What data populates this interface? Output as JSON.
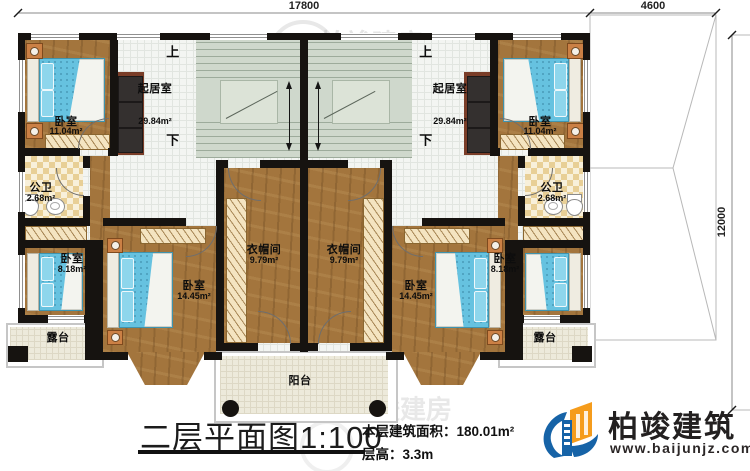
{
  "dims": {
    "width": "17800",
    "wing_width": "4600",
    "wing_height": "12000"
  },
  "nav": {
    "up": "上",
    "down": "下"
  },
  "rooms": {
    "living": {
      "name": "起居室",
      "area": "29.84m²"
    },
    "bedroom11": {
      "name": "卧室",
      "area": "11.04m²"
    },
    "bath": {
      "name": "公卫",
      "area": "2.68m²"
    },
    "closet": {
      "name": "衣帽间",
      "area": "9.79m²"
    },
    "bedroom8": {
      "name": "卧室",
      "area": "8.18m²"
    },
    "bedroom14": {
      "name": "卧室",
      "area": "14.45m²"
    },
    "terrace": {
      "name": "露台"
    },
    "balcony": {
      "name": "阳台"
    }
  },
  "title": {
    "main": "二层平面图",
    "scale": "1:100"
  },
  "stats": {
    "area_label": "本层建筑面积：",
    "area_value": "180.01m²",
    "height_label": "层高：",
    "height_value": "3.3m"
  },
  "brand": {
    "name": "柏竣建筑",
    "url": "www.baijunjz.com",
    "blue": "#1663a7",
    "orange": "#f59c1c"
  },
  "watermark": {
    "text": "柏竣建房"
  }
}
